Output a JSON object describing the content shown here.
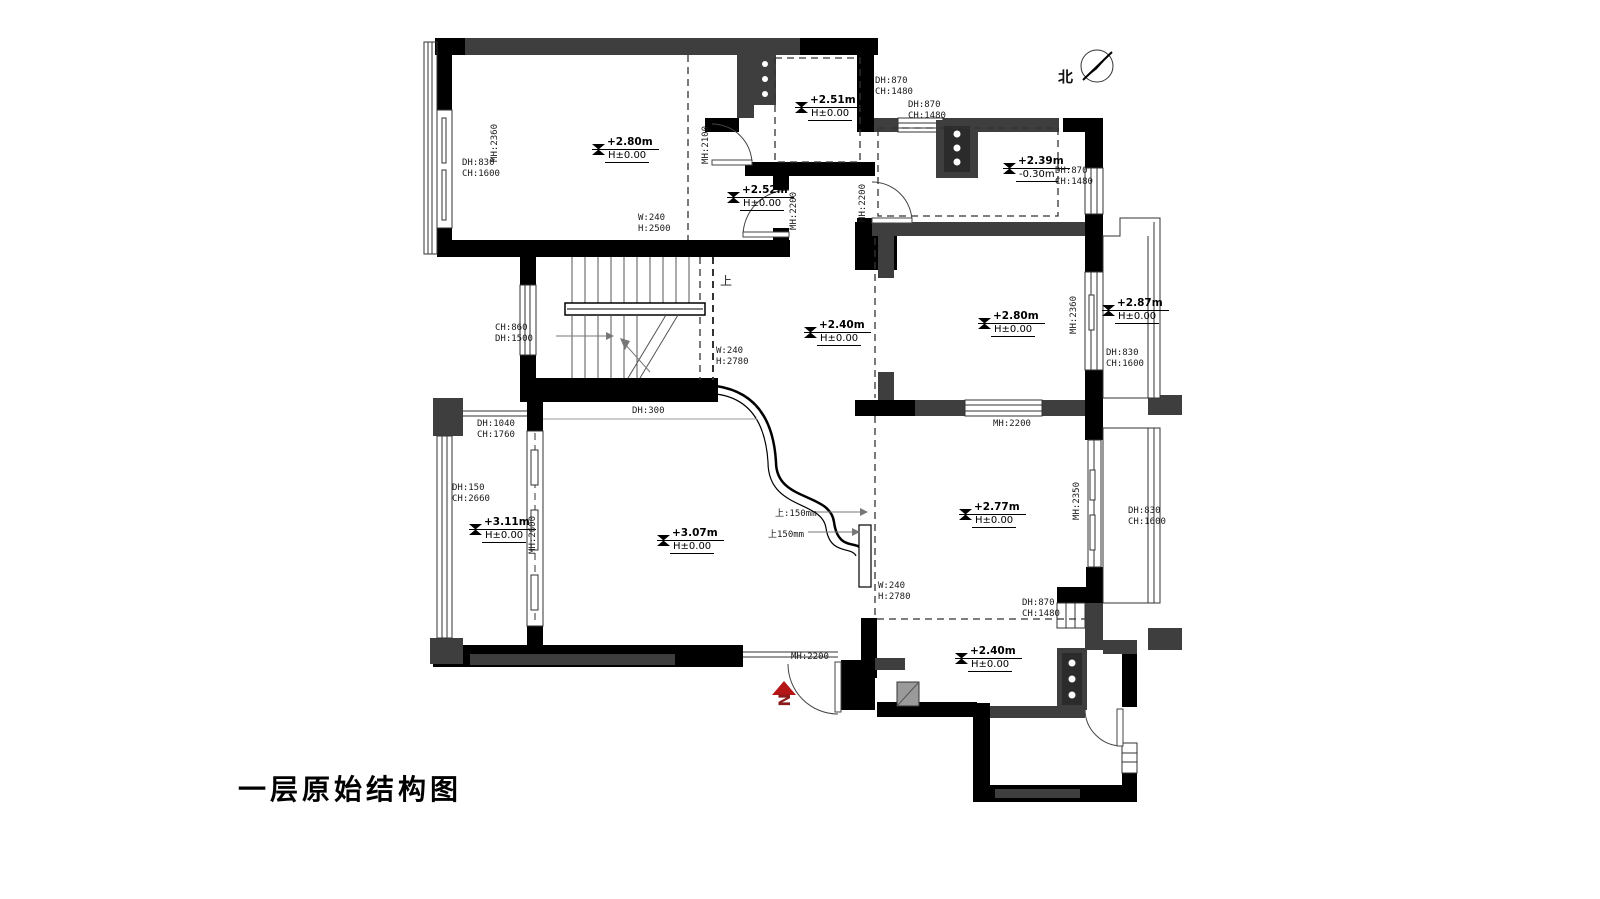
{
  "texts": {
    "title": "一层原始结构图",
    "north": "北",
    "up": "上",
    "step1": "上:150mm",
    "step2": "上150mm"
  },
  "elev": {
    "e1": {
      "value": "+2.80m",
      "base": "H±0.00"
    },
    "e2": {
      "value": "+2.51m",
      "base": "H±0.00"
    },
    "e3": {
      "value": "+2.52m",
      "base": "H±0.00"
    },
    "e4": {
      "value": "+2.39m",
      "base": "-0.30m"
    },
    "e5": {
      "value": "+2.40m",
      "base": "H±0.00"
    },
    "e6": {
      "value": "+2.80m",
      "base": "H±0.00"
    },
    "e7": {
      "value": "+2.87m",
      "base": "H±0.00"
    },
    "e8": {
      "value": "+3.11m",
      "base": "H±0.00"
    },
    "e9": {
      "value": "+3.07m",
      "base": "H±0.00"
    },
    "e10": {
      "value": "+2.77m",
      "base": "H±0.00"
    },
    "e11": {
      "value": "+2.40m",
      "base": "H±0.00"
    }
  },
  "labels": {
    "dh830_left": "DH:830\nCH:1600",
    "dh870_a": "DH:870\nCH:1480",
    "dh870_b": "DH:870\nCH:1480",
    "dh870_right_top": "DH:870\nCH:1480",
    "w240_top": "W:240\nH:2500",
    "ch860": "CH:860\nDH:1500",
    "w240_stairs": "W:240\nH:2780",
    "dh300": "DH:300",
    "dh1040": "DH:1040\nCH:1760",
    "dh150": "DH:150\nCH:2660",
    "dh830_right_top": "DH:830\nCH:1600",
    "mh2200_e": "MH:2200",
    "w240_i": "W:240\nH:2780",
    "dh870_bot": "DH:870\nCH:1480",
    "dh830_right_bot": "DH:830\nCH:1600",
    "mh2200_entry": "MH:2200",
    "mh2360_left": "MH:2360",
    "mh2100": "MH:2100",
    "mh2200_c": "MH:2200",
    "mh2200_d": "MH:2200",
    "mh2360_right": "MH:2360",
    "mh2600": "MH:2600",
    "mh2350": "MH:2350"
  },
  "colors": {
    "wall_black": "#000000",
    "wall_gray": "#3e3e3e",
    "entry_red": "#b51616",
    "line": "#333333"
  }
}
